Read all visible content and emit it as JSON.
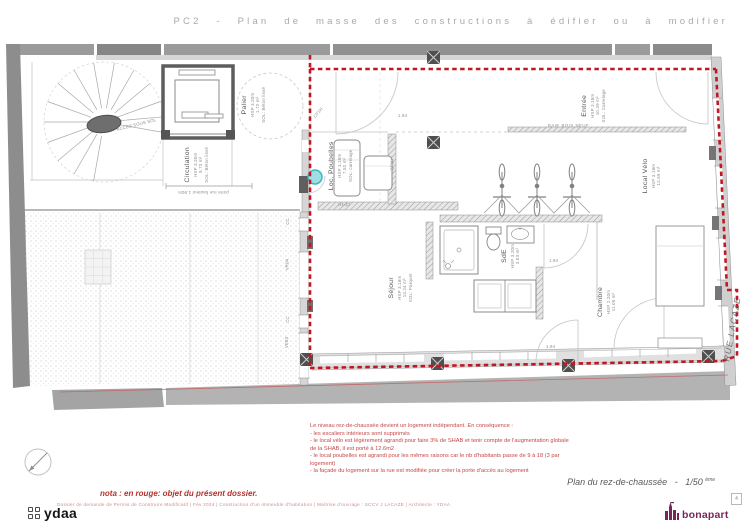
{
  "header": {
    "title": "PC2 - Plan de masse des constructions à édifier ou à modifier"
  },
  "rooms": [
    {
      "name": "Palier",
      "hsp": "HSP 3.20m",
      "area": "1.72 m²",
      "sol": "SOL: Béton lissé"
    },
    {
      "name": "Circulation",
      "hsp": "HSP 3.20m",
      "area": "9.73 m²",
      "sol": "SOL: Béton lissé"
    },
    {
      "name": "Entrée",
      "hsp": "HSP 3.18m",
      "area": "10.39 m²",
      "sol": "SOL: Carrelage"
    },
    {
      "name": "Local Vélo",
      "hsp": "HSP 3.18m",
      "area": "12.69 m²",
      "sol": ""
    },
    {
      "name": "Loc. Poubelles",
      "hsp": "HSP 3.18m",
      "area": "7.52 m²",
      "sol": "SOL: carrelage"
    },
    {
      "name": "Séjour",
      "hsp": "HSP 3.18m",
      "area": "13.24 m²",
      "sol": "SOL: Parquet"
    },
    {
      "name": "SdE",
      "hsp": "HSP 3.20m",
      "area": "3.03 m²",
      "sol": ""
    },
    {
      "name": "Chambre",
      "hsp": "HSP 2.20m",
      "area": "11.05 m²",
      "sol": ""
    }
  ],
  "plan_labels": {
    "street": "RUE LACAZE",
    "acces_sous_sol": "ACCES SOUS SOL",
    "porte_rue": "porte rue hauteur 1.90m",
    "cf1h": "CF1H",
    "baie": "BAIE BOIS NEUF",
    "dim_door": "1.94",
    "win_cc": "CC",
    "win_vr04": "VR04",
    "win_ve03": "VE03"
  },
  "notes": {
    "nota": "nota : en rouge: objet du présent dossier.",
    "lines": [
      "Le niveau rez-de-chaussée devient un logement indépendant. En conséquence :",
      "- les escaliers intérieurs sont supprimés",
      "- le local vélo est légèrement agrandi pour faire 3% de SHAB et tenir compte de l'augmentation globale de la SHAB, il est porté à 12.6m2",
      "- le local poubelles est agrandi pour les mêmes raisons car le nb d'habitants passe de 9 à 18 (3 par logement)",
      "- la façade du logement sur la rue est modifiée pour créer la porte d'accès au logement"
    ]
  },
  "titleblock": {
    "plan_title": "Plan du rez-de-chaussée",
    "scale_sep": "-",
    "scale": "1/50",
    "scale_sup": "ème",
    "footer": "Dossier de demande de Permis de Construire Modificatif | Fév 2024 | Construction d'un immeuble d'habitation | Maîtrise d'ouvrage : SCCV J LACAZE | Architecte : YDAA",
    "page_number": "4",
    "brand_left": "ydaa",
    "brand_right": "bonapart"
  },
  "colors": {
    "red_dash": "#bf1824",
    "note_red": "#c64747",
    "brand_purple": "#77265c"
  }
}
